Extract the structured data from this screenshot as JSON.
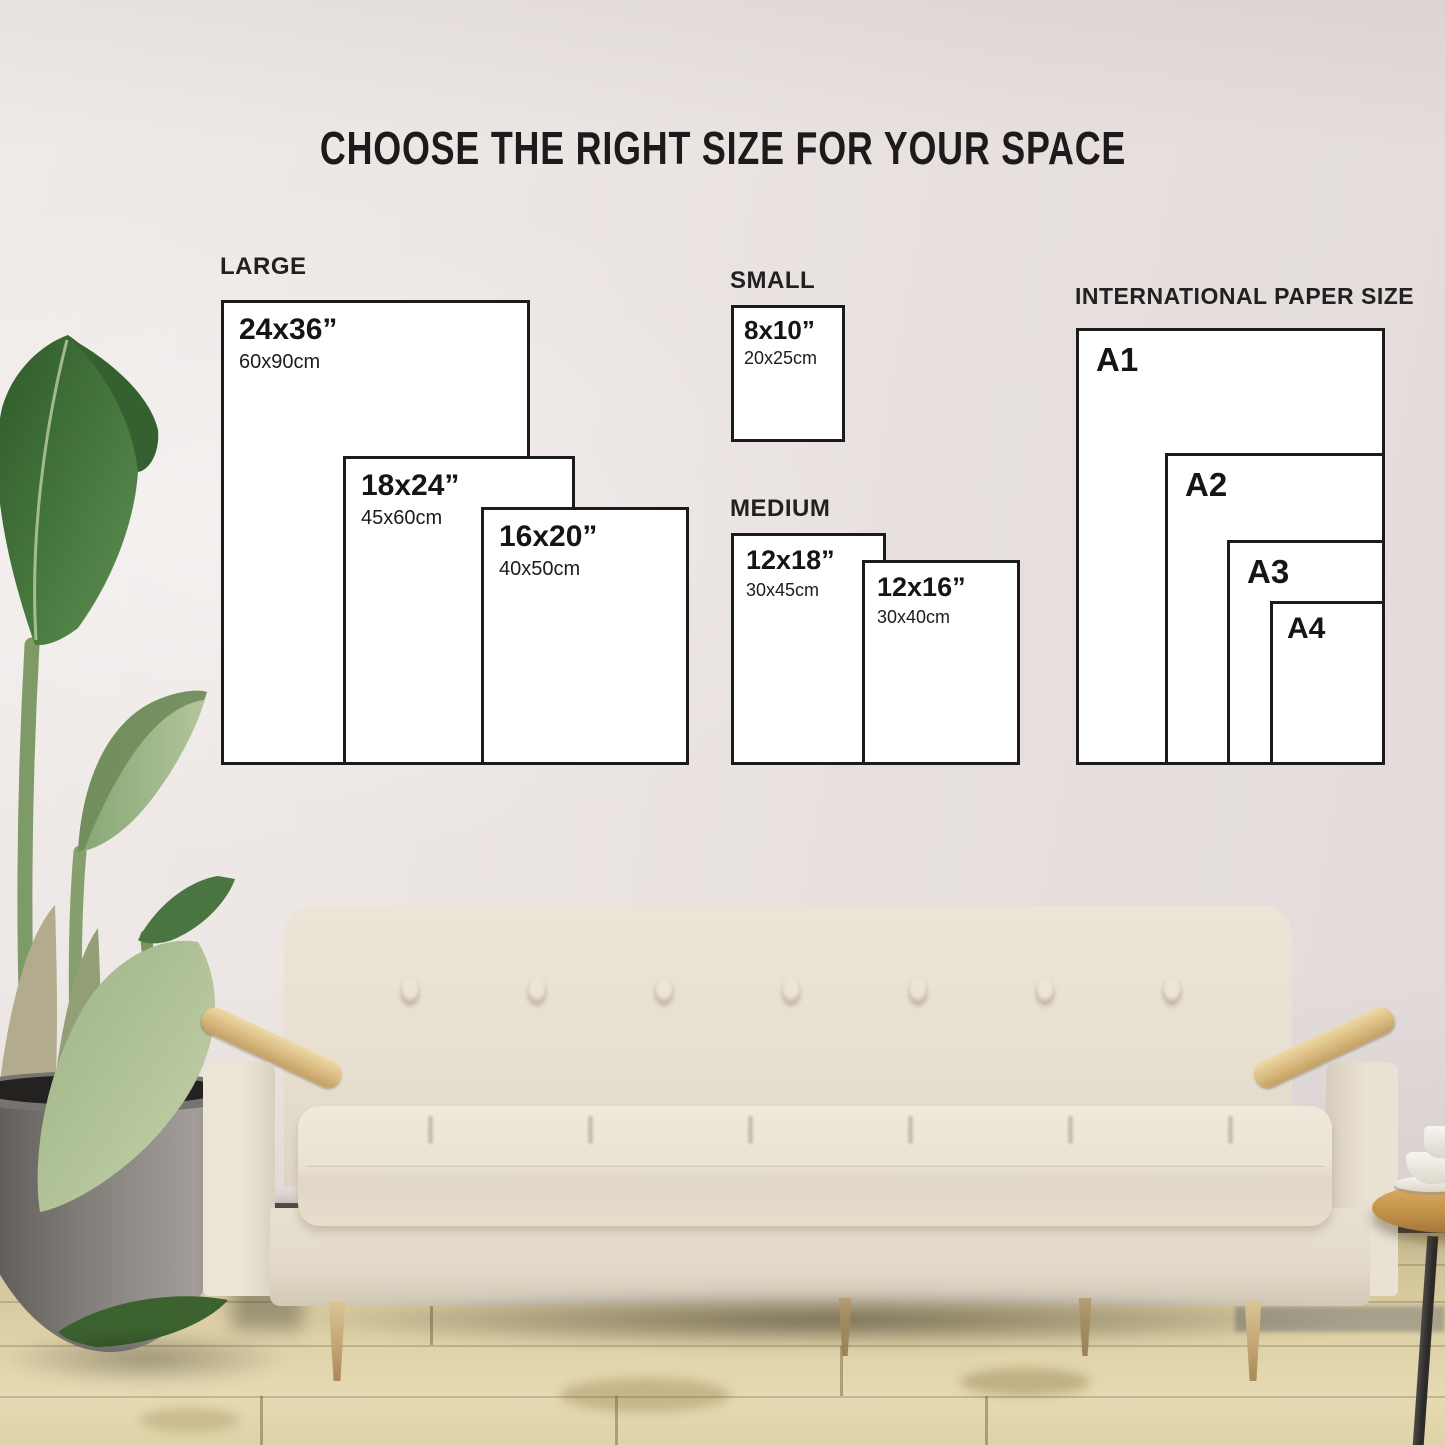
{
  "title": "CHOOSE THE RIGHT SIZE FOR YOUR SPACE",
  "groups": [
    {
      "id": "large",
      "label": "LARGE",
      "sizes": [
        {
          "inches": "24x36”",
          "cm": "60x90cm"
        },
        {
          "inches": "18x24”",
          "cm": "45x60cm"
        },
        {
          "inches": "16x20”",
          "cm": "40x50cm"
        }
      ]
    },
    {
      "id": "small",
      "label": "SMALL",
      "sizes": [
        {
          "inches": "8x10”",
          "cm": "20x25cm"
        }
      ]
    },
    {
      "id": "medium",
      "label": "MEDIUM",
      "sizes": [
        {
          "inches": "12x18”",
          "cm": "30x45cm"
        },
        {
          "inches": "12x16”",
          "cm": "30x40cm"
        }
      ]
    },
    {
      "id": "international",
      "label": "INTERNATIONAL PAPER SIZE",
      "sizes": [
        {
          "name": "A1"
        },
        {
          "name": "A2"
        },
        {
          "name": "A3"
        },
        {
          "name": "A4"
        }
      ]
    }
  ],
  "colors": {
    "box_border": "#1b1b1b",
    "box_fill": "#ffffff",
    "text": "#1a1818",
    "wall": "#e9e3e1",
    "floor_wood": "#d8caa0",
    "sofa_fabric": "#e8e0d2",
    "armrest_wood": "#d7b67c",
    "plant_leaf": "#4a7440",
    "plant_pot": "#807c79"
  }
}
